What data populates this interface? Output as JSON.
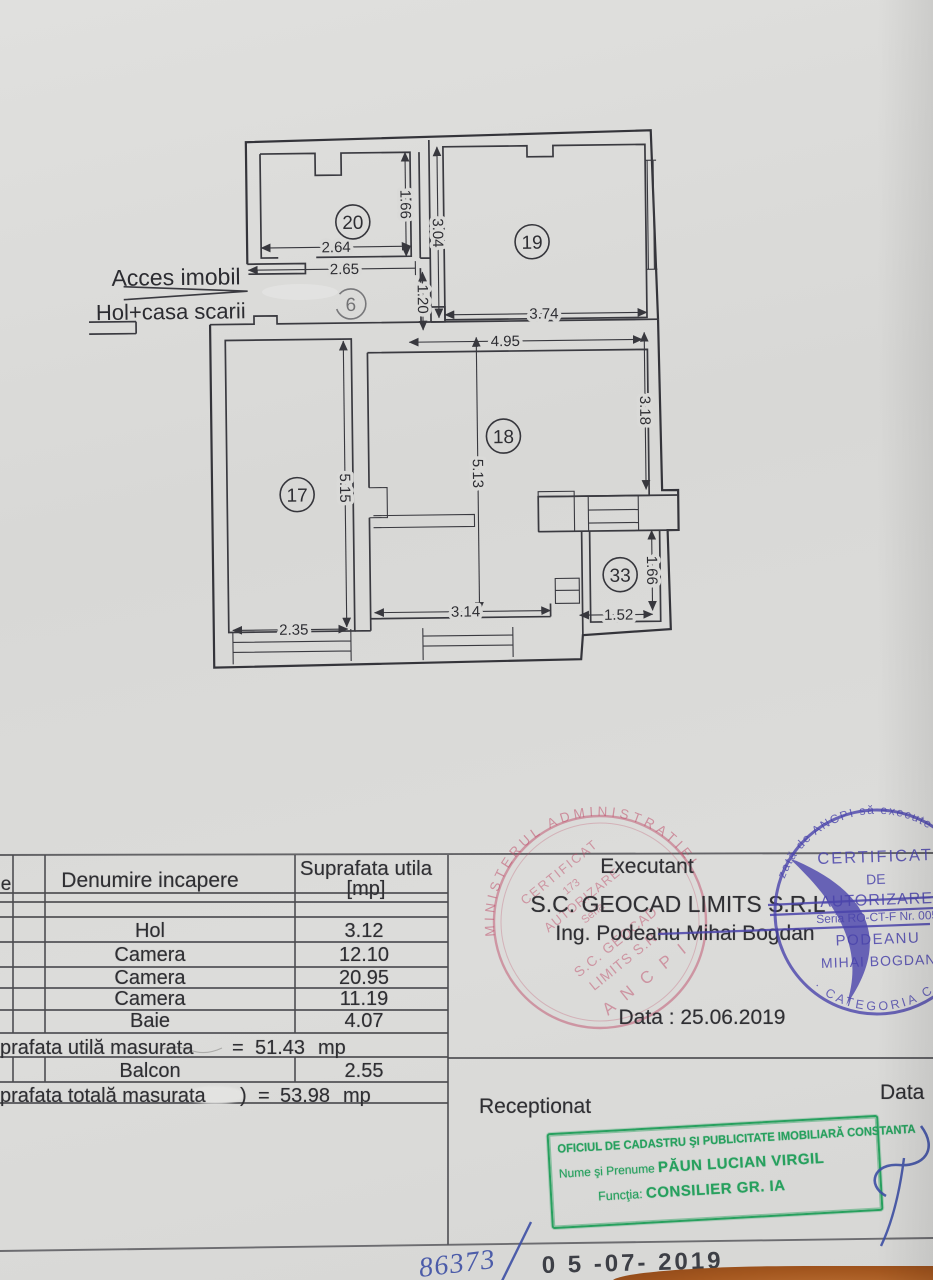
{
  "plan": {
    "access_label": "Acces imobil",
    "stairs_label": "Hol+casa scarii",
    "rooms": {
      "r20": "20",
      "r19": "19",
      "r6": "6",
      "r17": "17",
      "r18": "18",
      "r33": "33"
    },
    "dims": {
      "w20": "2.64",
      "hall_w": "2.65",
      "h20": "1.66",
      "h19_left": "3.04",
      "h_hall": "1.20",
      "w19": "3.74",
      "w18_top": "4.95",
      "h18_right": "3.18",
      "h17": "5.15",
      "h18": "5.13",
      "w18_bottom": "3.14",
      "w17": "2.35",
      "w33": "1.52",
      "h33": "1.66"
    }
  },
  "table": {
    "header": {
      "left_fragment": "e",
      "name_col": "Denumire incapere",
      "area_col_line1": "Suprafata utila",
      "area_col_line2": "[mp]"
    },
    "rows": [
      {
        "name": "Hol",
        "area": "3.12"
      },
      {
        "name": "Camera",
        "area": "12.10"
      },
      {
        "name": "Camera",
        "area": "20.95"
      },
      {
        "name": "Camera",
        "area": "11.19"
      },
      {
        "name": "Baie",
        "area": "4.07"
      }
    ],
    "useful": {
      "label": "prafata utilă masurata",
      "eq": "=",
      "value": "51.43",
      "unit": "mp"
    },
    "balcony": {
      "name": "Balcon",
      "area": "2.55"
    },
    "total": {
      "label": "prafata totală masurata",
      "paren": ")",
      "eq": "=",
      "value": "53.98",
      "unit": "mp"
    }
  },
  "executant": {
    "title": "Executant",
    "company": "S.C. GEOCAD LIMITS S.R.L",
    "engineer": "Ing. Podeanu Mihai Bogdan",
    "date": "Data : 25.06.2019"
  },
  "reception": {
    "title": "Receptionat",
    "date_label": "Data"
  },
  "green_stamp": {
    "line1": "OFICIUL DE CADASTRU ŞI PUBLICITATE IMOBILIARĂ CONSTANTA",
    "name_label": "Nume şi Prenume",
    "name_value": "PĂUN LUCIAN VIRGIL",
    "function_label": "Funcţia:",
    "function_value": "CONSILIER GR. IA",
    "color": "#27a05e"
  },
  "red_stamp": {
    "ring": "MINISTERUL ADMINISTRATIEI",
    "l1": "CERTIFICAT",
    "l2": "173",
    "l3": "AUTORIZARE",
    "l4": "Seria",
    "l5": "S.C. GEOCAD",
    "l6": "LIMITS S.R.L",
    "l7": "A N C P I",
    "color": "#bf4f6b"
  },
  "blue_stamp": {
    "ring_top": "zată de ANCPI să execute lucrări de",
    "ring_bottom": "· CATEGORIA C ·",
    "l1": "CERTIFICAT",
    "l2": "DE",
    "l3": "AUTORIZARE",
    "l4": "Seria RO-CT-F Nr. 005",
    "l5": "PODEANU",
    "l6": "MIHAI BOGDAN",
    "color": "#4a44ab"
  },
  "handwriting": {
    "number": "86373",
    "date_stamp": "0 5 -07- 2019"
  }
}
